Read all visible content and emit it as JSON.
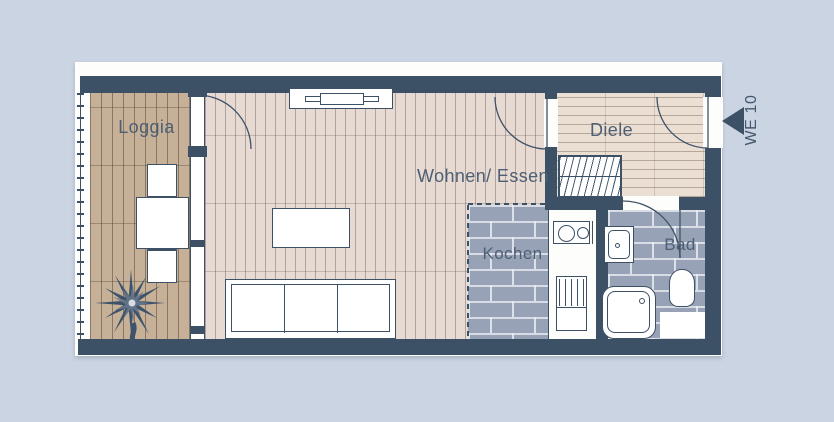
{
  "unit": {
    "label": "WE 10"
  },
  "rooms": {
    "loggia": {
      "label": "Loggia"
    },
    "wohnen_essen": {
      "label": "Wohnen/ Essen"
    },
    "kochen": {
      "label": "Kochen"
    },
    "diele": {
      "label": "Diele"
    },
    "bad": {
      "label": "Bad"
    }
  },
  "colors": {
    "background": "#cbd4e2",
    "wall": "#3c5066",
    "tile": "#97a2b6",
    "loggia_wood": "#c6b097",
    "living_wood": "#e7dad3",
    "diele_wood": "#ebdfd3",
    "label_text": "#4d5f74"
  }
}
